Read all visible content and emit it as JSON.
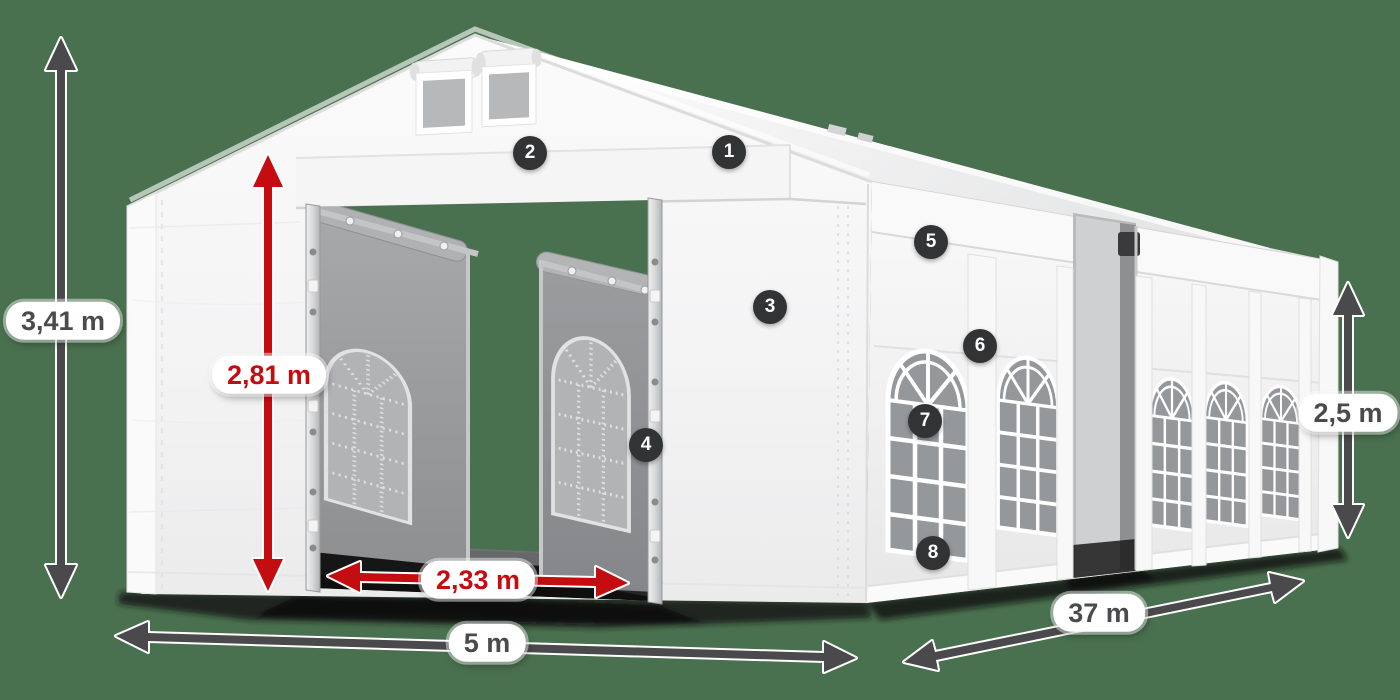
{
  "scene": {
    "description": "Party tent 5 x 37 m dimension diagram with numbered feature markers",
    "background_color": "#4a714f",
    "tent_color": "#f5f5f6",
    "arrow_dark_color": "#4a4a4c",
    "arrow_red_color": "#c40d10",
    "badge_color": "#323335",
    "label_background": "#ffffff"
  },
  "dimensions": {
    "total_height": "3,41 m",
    "entrance_height": "2,81 m",
    "entrance_width": "2,33 m",
    "gable_width": "5 m",
    "length": "37 m",
    "side_height": "2,5 m"
  },
  "markers": [
    {
      "number": "1"
    },
    {
      "number": "2"
    },
    {
      "number": "3"
    },
    {
      "number": "4"
    },
    {
      "number": "5"
    },
    {
      "number": "6"
    },
    {
      "number": "7"
    },
    {
      "number": "8"
    }
  ]
}
